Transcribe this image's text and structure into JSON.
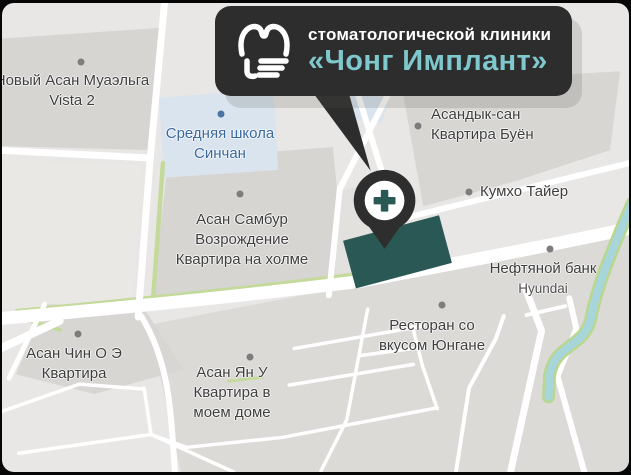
{
  "callout": {
    "clinic_type": "стоматологической клиники",
    "clinic_name": "«Чонг Имплант»",
    "logo": "tooth-icon",
    "bg_color": "#2d2d2d",
    "brand_color": "#7fc8cd"
  },
  "map": {
    "pin_icon": "medical-cross-icon",
    "pois": [
      {
        "id": "vista2",
        "lines": [
          "Новый Асан Муаэльга",
          "Vista 2"
        ]
      },
      {
        "id": "school",
        "lines": [
          "Средняя школа",
          "Синчан"
        ]
      },
      {
        "id": "sambur",
        "lines": [
          "Асан Самбур",
          "Возрождение",
          "Квартира на холме"
        ]
      },
      {
        "id": "asandyk",
        "lines": [
          "Асандык-сан",
          "Квартира Буён"
        ]
      },
      {
        "id": "kumho",
        "lines": [
          "Кумхо Тайер"
        ]
      },
      {
        "id": "oilbank",
        "lines": [
          "Нефтяной банк",
          "Hyundai"
        ]
      },
      {
        "id": "restaurant",
        "lines": [
          "Ресторан со",
          "вкусом Юнгане"
        ]
      },
      {
        "id": "chin",
        "lines": [
          "Асан Чин О Э",
          "Квартира"
        ]
      },
      {
        "id": "yanu",
        "lines": [
          "Асан Ян У",
          "Квартира в",
          "моем доме"
        ]
      }
    ],
    "colors": {
      "background": "#e9e7e5",
      "block": "#d7d5d2",
      "school_area": "#dae4ee",
      "road": "#ffffff",
      "greenway": "#c3da9b",
      "river": "#a7d5da",
      "clinic_building": "#2a5955",
      "pin": "#2e2e2e",
      "label_text": "#3e3e3e",
      "school_label_text": "#39689e"
    }
  }
}
